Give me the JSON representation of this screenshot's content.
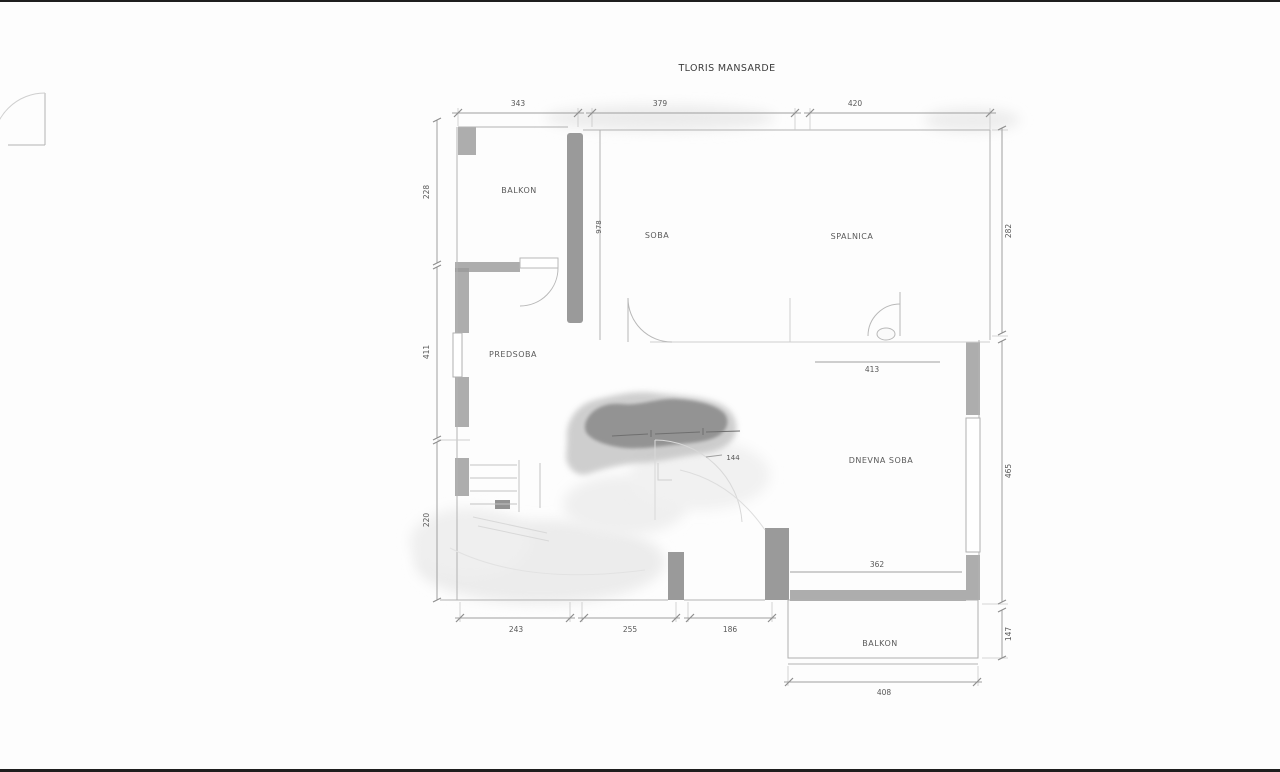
{
  "title": "TLORIS MANSARDE",
  "rooms": {
    "balkon_top": "BALKON",
    "soba": "SOBA",
    "spalnica": "SPALNICA",
    "predsoba": "PREDSOBA",
    "dnevna_soba": "DNEVNA SOBA",
    "balkon_bottom": "BALKON"
  },
  "dimensions": {
    "top": [
      "343",
      "379",
      "420"
    ],
    "left": [
      "228",
      "411",
      "220"
    ],
    "right": [
      "282",
      "465",
      "147"
    ],
    "bottom": [
      "243",
      "255",
      "186"
    ],
    "balcony_bottom": "408",
    "interior": {
      "spalnica_below": "413",
      "dnevna_bottom": "362",
      "center_small": "144",
      "wall_vertical": "978"
    }
  },
  "colors": {
    "line": "#b2b2b2",
    "wall": "#9b9b9b",
    "text": "#565656",
    "smudge_dark": "#8d8d8d",
    "smudge_light": "#c6c6c6",
    "edge_bar": "#1e1e1e"
  }
}
